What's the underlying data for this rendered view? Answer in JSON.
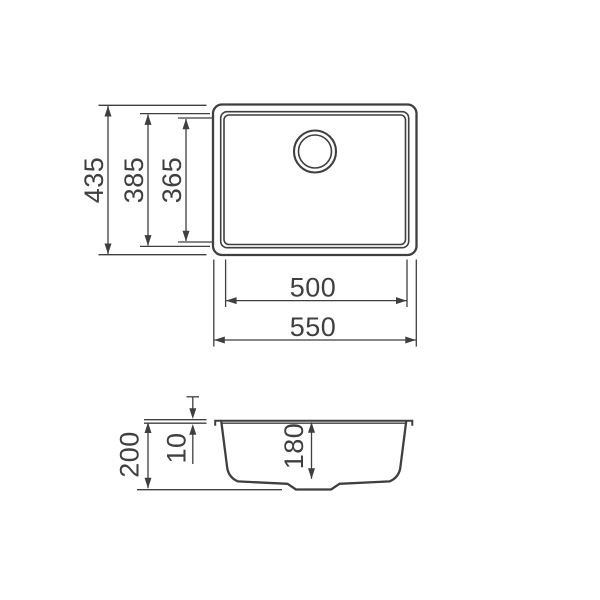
{
  "drawing": {
    "type": "sink technical drawing, top view and section view",
    "line_color": "#3f3f3f",
    "background_color": "#ffffff",
    "top_view": {
      "overall_height": "435",
      "rim_opening_height": "385",
      "basin_height": "365",
      "basin_width": "500",
      "overall_width": "550"
    },
    "section_view": {
      "overall_depth": "200",
      "rim_thickness": "10",
      "basin_depth": "180"
    }
  }
}
